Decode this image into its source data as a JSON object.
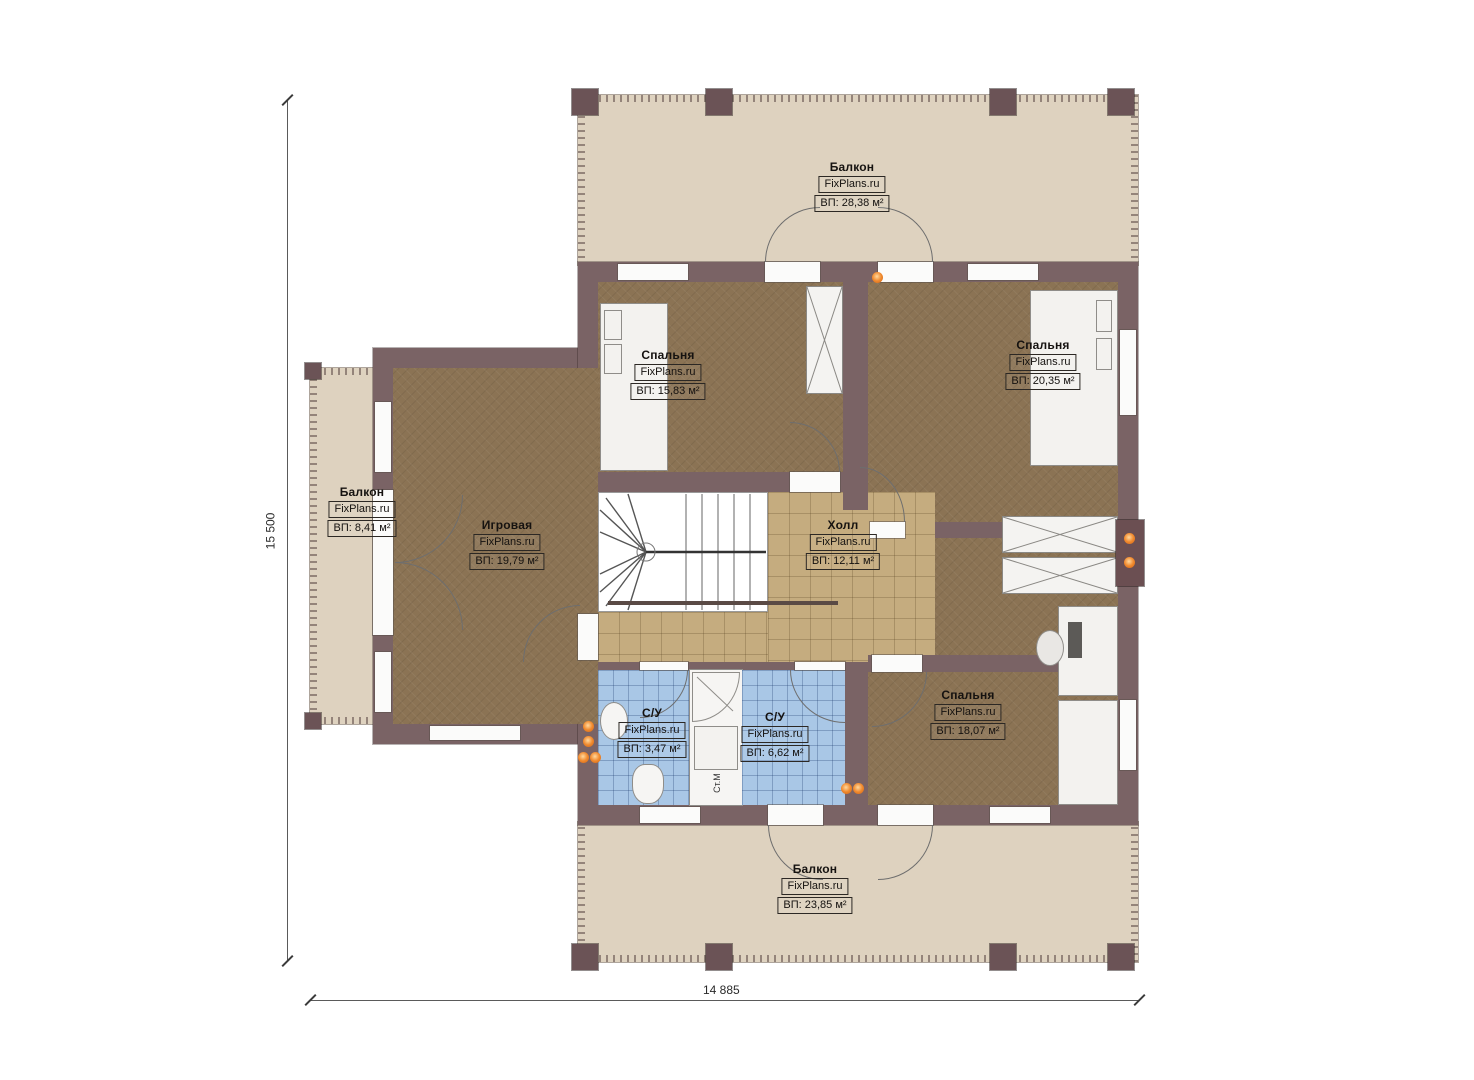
{
  "plan": {
    "watermark": "FixPlans.ru",
    "rooms": [
      {
        "id": "balcony-top",
        "name": "Балкон",
        "area": "ВП: 28,38 м²"
      },
      {
        "id": "bedroom-top-left",
        "name": "Спальня",
        "area": "ВП: 15,83 м²"
      },
      {
        "id": "bedroom-top-right",
        "name": "Спальня",
        "area": "ВП: 20,35 м²"
      },
      {
        "id": "balcony-left",
        "name": "Балкон",
        "area": "ВП: 8,41 м²"
      },
      {
        "id": "playroom",
        "name": "Игровая",
        "area": "ВП: 19,79 м²"
      },
      {
        "id": "hall",
        "name": "Холл",
        "area": "ВП: 12,11 м²"
      },
      {
        "id": "bedroom-bottom",
        "name": "Спальня",
        "area": "ВП: 18,07 м²"
      },
      {
        "id": "bath-left",
        "name": "С/У",
        "area": "ВП: 3,47 м²"
      },
      {
        "id": "bath-right",
        "name": "С/У",
        "area": "ВП: 6,62 м²"
      },
      {
        "id": "balcony-bottom",
        "name": "Балкон",
        "area": "ВП: 23,85 м²"
      }
    ],
    "appliances": {
      "washing_machine": "Ст.М"
    },
    "dimensions": {
      "height_label": "15 500",
      "width_label": "14 885"
    },
    "colors": {
      "wall": "#7a6365",
      "floor": "#8b7354",
      "hall_tile": "#c5ac7f",
      "bath_tile": "#a9c7e6",
      "balcony": "#ded2bf",
      "accent_dots": "#f08a2e"
    }
  }
}
